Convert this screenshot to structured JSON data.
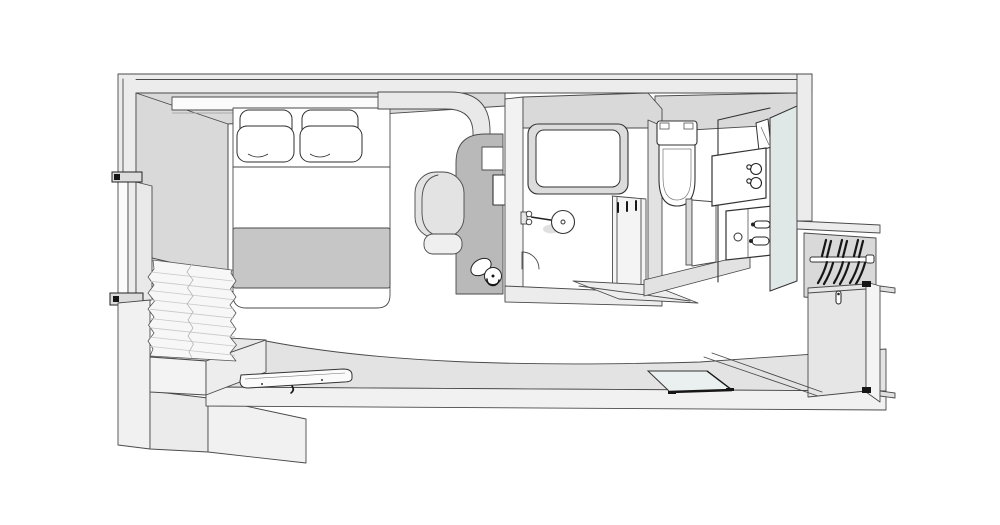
{
  "drawing": {
    "kind": "axonometric-cutaway-floor-plan",
    "rooms": [
      {
        "name": "bedroom",
        "fixtures": [
          "bed",
          "pillows",
          "headboard-shelf",
          "window",
          "curtain",
          "bench",
          "wall-shelf",
          "desk",
          "chair",
          "kettle"
        ]
      },
      {
        "name": "shower-room",
        "fixtures": [
          "bathtub",
          "rain-shower",
          "door-swing",
          "towel-rack",
          "sliding-door"
        ]
      },
      {
        "name": "toilet-room",
        "fixtures": [
          "toilet",
          "toilet-room-door"
        ]
      },
      {
        "name": "vanity-area",
        "fixtures": [
          "wall-light",
          "amenity-shelf",
          "cups",
          "washbasin",
          "mirror-panel"
        ]
      },
      {
        "name": "entry",
        "fixtures": [
          "closet-rod",
          "hangers",
          "entry-door",
          "glass-panel"
        ]
      }
    ]
  },
  "colors": {
    "white": "#ffffff",
    "wall": "#ececec",
    "wallface": "#d9d9d9",
    "band": "#e3e3e3",
    "front": "#f1f1f1",
    "soffit": "#e9e9e9",
    "desk": "#b9b9b9",
    "runner": "#c6c6c6",
    "mirror": "#dfe8e7",
    "glass": "#e9f0ef",
    "paper": "#fbfbfb",
    "curtain": "#f7f7f7",
    "pleat": "#c8c8c8",
    "fixture": "#f2f2f2",
    "chair": "#e3e3e3",
    "seat": "#efefef",
    "line": "#4a4a4a",
    "line2": "#333333",
    "dark": "#161616"
  }
}
